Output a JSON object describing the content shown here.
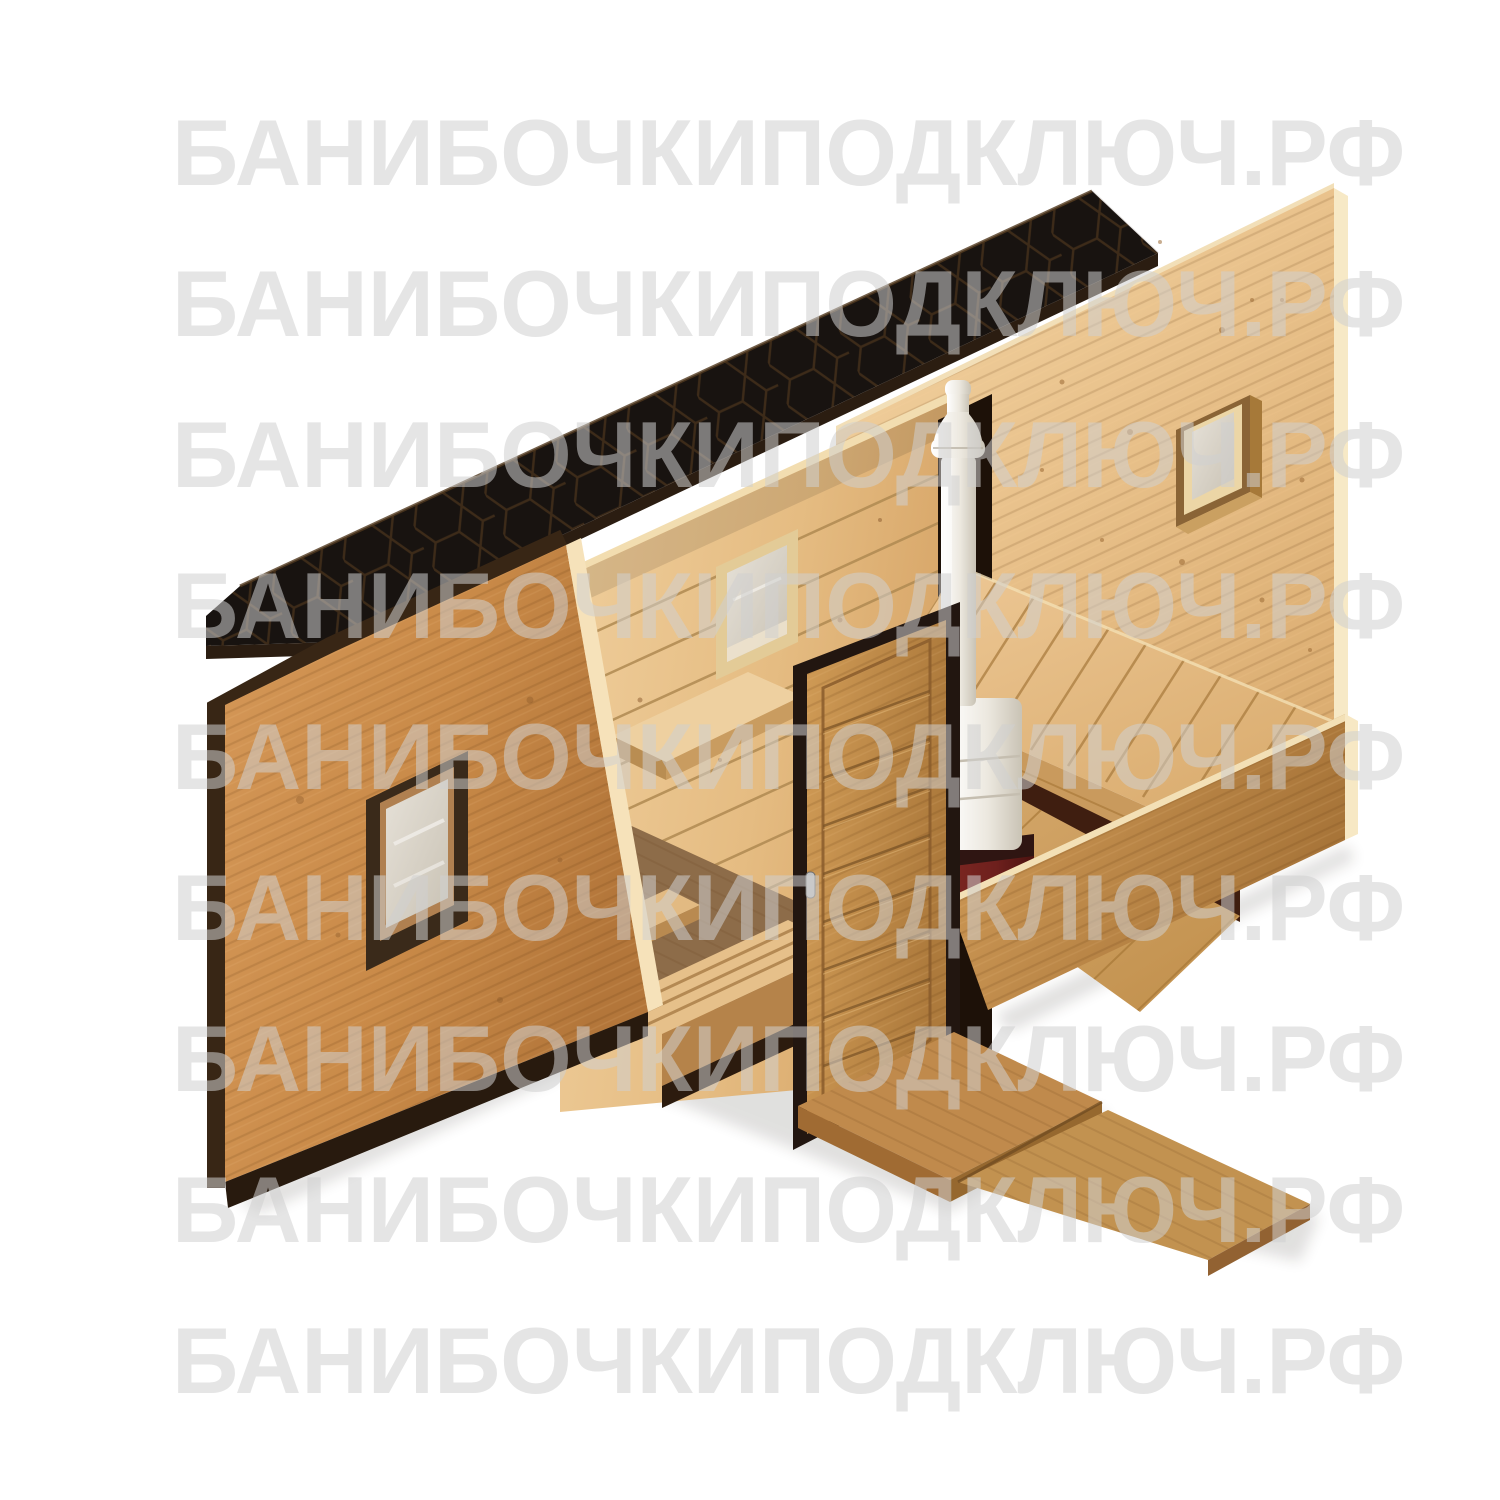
{
  "page": {
    "background": "#ffffff",
    "width": 1500,
    "height": 1500
  },
  "watermark": {
    "text": "БАНИБОЧКИПОДКЛЮЧ.РФ",
    "color": "rgba(208,208,208,0.55)",
    "font_size_px": 94,
    "left_px": 172,
    "row_tops_px": [
      106,
      257,
      408,
      559,
      710,
      861,
      1012,
      1163,
      1314
    ]
  },
  "illustration": {
    "alt": "Isometric 3D cutaway render of a rectangular wooden banya (sauna cabin): black hexagonal-shingle pent roof, honey-colored front wall with square window, interior washroom with benches, plank partition with small window, steam room with slatted bench, white wood-fired stove with burgundy base and white chimney pipe, wooden entrance door with step platform and ramp",
    "colors": {
      "roof": "#181310",
      "roof_pattern_line": "#46311c",
      "roof_fascia": "#2b1d11",
      "wall_front_light": "#d29355",
      "wall_front_dark": "#b97c3e",
      "trim_dark": "#382615",
      "cut_edge_cream": "#f6e2ba",
      "pine_light": "#f0cf9d",
      "pine_dark": "#d9a96c",
      "plank_gap": "#a87c46",
      "glass": "#d8d2c8",
      "floor_dark": "#8d6c49",
      "under_bench_shadow": "#3f1e10",
      "stove_white": "#f7f4ed",
      "stove_white_shade": "#cfc9bb",
      "stove_base_red": "#6e201d",
      "door_leaf": "#c99350",
      "door_frame": "#221610"
    }
  }
}
